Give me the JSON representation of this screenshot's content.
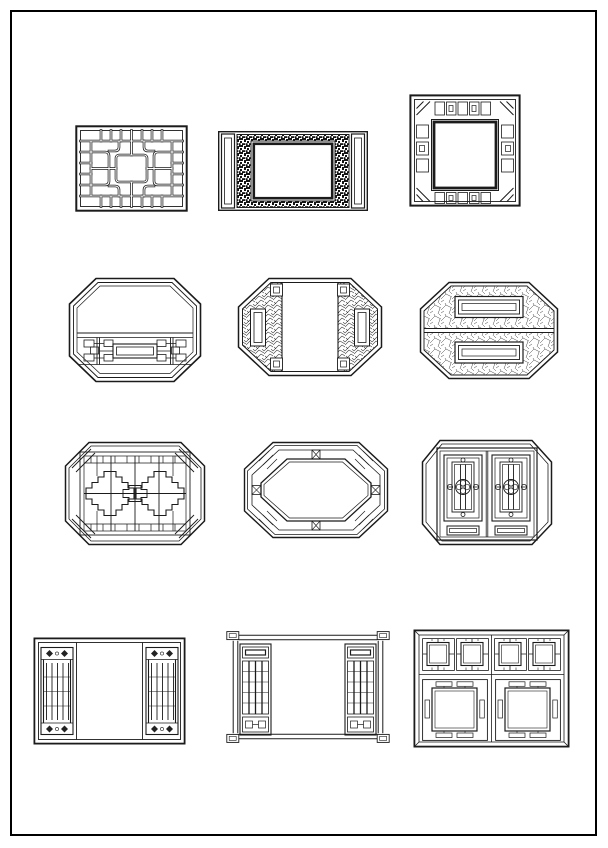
{
  "page": {
    "kind": "cad-lattice-window-catalog-sheet",
    "background_color": "#ffffff",
    "frame_border_color": "#000000",
    "line_color": "#1b1b1b",
    "grid": {
      "rows": 4,
      "columns": 3
    }
  },
  "drawings": [
    {
      "id": 1,
      "row": 1,
      "col": 1,
      "name": "rectangular key-fret lattice window"
    },
    {
      "id": 2,
      "row": 1,
      "col": 2,
      "name": "rectangular dark fretwork frame with side pilasters"
    },
    {
      "id": 3,
      "row": 1,
      "col": 3,
      "name": "square frame with baluster border and corner scrolls"
    },
    {
      "id": 4,
      "row": 2,
      "col": 1,
      "name": "octagonal window with lower interlocking lattice band"
    },
    {
      "id": 5,
      "row": 2,
      "col": 2,
      "name": "octagonal window with carved side panels and open center"
    },
    {
      "id": 6,
      "row": 2,
      "col": 3,
      "name": "octagonal window with ice-crackle halves and cartouches"
    },
    {
      "id": 7,
      "row": 3,
      "col": 1,
      "name": "octagonal window with stepped diamond lattice"
    },
    {
      "id": 8,
      "row": 3,
      "col": 2,
      "name": "octagonal window with concentric banded border"
    },
    {
      "id": 9,
      "row": 3,
      "col": 3,
      "name": "octagonal frame with two carved door panels"
    },
    {
      "id": 10,
      "row": 4,
      "col": 1,
      "name": "rectangular window with slatted side panels"
    },
    {
      "id": 11,
      "row": 4,
      "col": 2,
      "name": "bracket-cornered frame with lattice side panels"
    },
    {
      "id": 12,
      "row": 4,
      "col": 3,
      "name": "six-panel square lattice window"
    }
  ]
}
